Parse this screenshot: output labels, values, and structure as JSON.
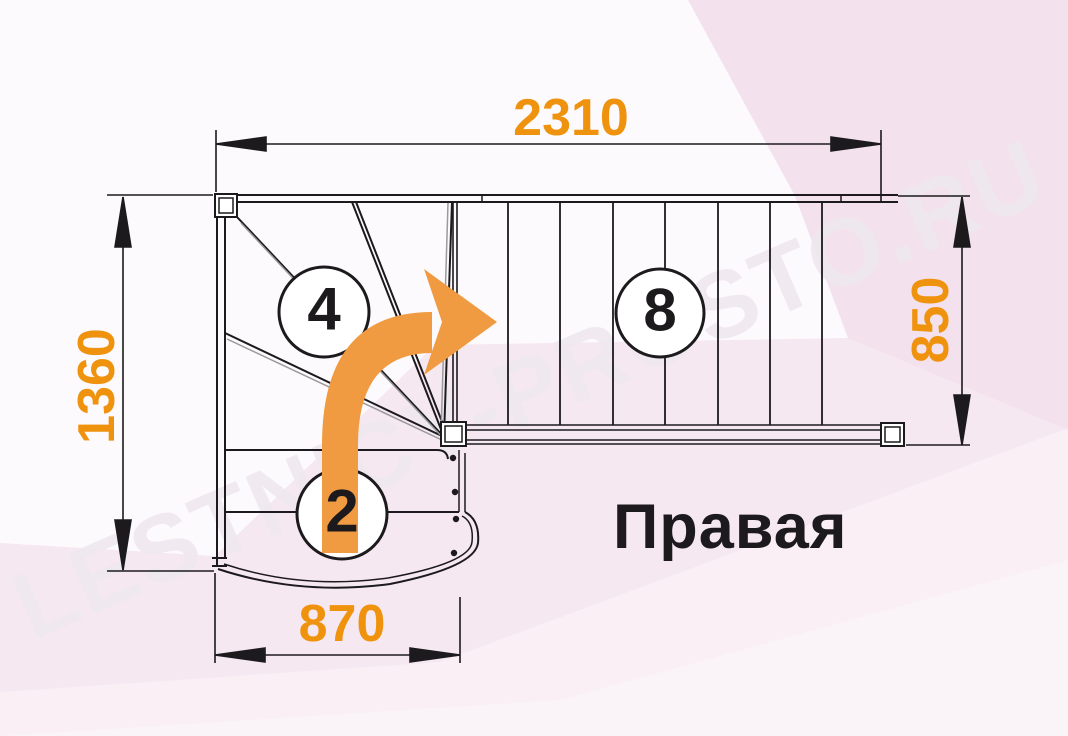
{
  "diagram": {
    "type": "staircase-plan-top-view",
    "direction_label": "Правая",
    "watermark": "LESTNICY-PROSTO.RU",
    "dimensions": {
      "top_width": "2310",
      "left_height": "1360",
      "right_flight_width": "850",
      "bottom_flight_width": "870"
    },
    "step_counts": {
      "winder_steps": "4",
      "lower_flight_steps": "2",
      "straight_flight_steps": "8"
    },
    "icons": {
      "turn_arrow": "curved-right-turn-arrow"
    },
    "colors": {
      "accent_orange": "#EF930F",
      "arrow_orange": "#F09B41",
      "line_ink": "#1C1A1C",
      "background_pink": "#F6E8F1",
      "panel_white": "#FCFAFC",
      "watermark_gray": "#EFE8EF"
    }
  }
}
